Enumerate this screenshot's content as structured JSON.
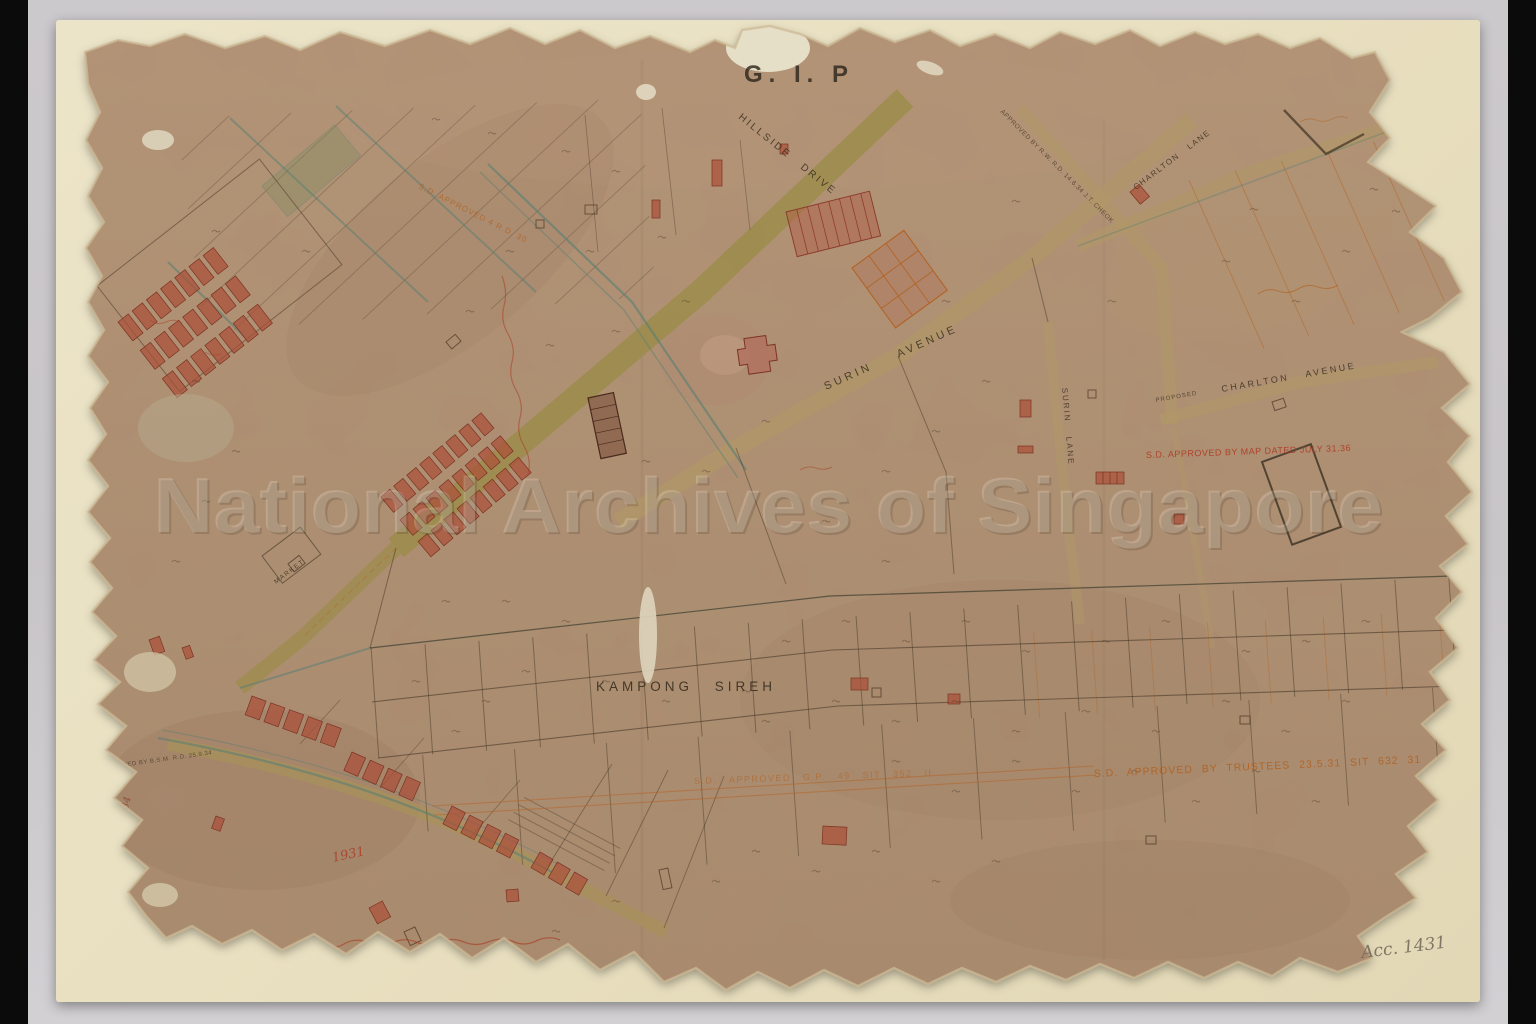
{
  "colors": {
    "orange_ink": "#b2601f",
    "red_ink": "#b03a24",
    "dark_ink": "#3c301f",
    "pencil": "#837a69",
    "map_paper": "#a8896c",
    "backing_paper": "#e9e0c1",
    "mat": "#cac7ca",
    "road_olive": "#9c8c4b",
    "road_tan": "#b19768",
    "drain_teal": "#567e73",
    "building_red": "#aa5039"
  },
  "archive": {
    "watermark": "National Archives of Singapore",
    "stamp": "G. I. P",
    "accession": "Acc. 1431",
    "pencil_number": "152",
    "margin_number": "A.L. No. 14.34",
    "year_note": "1931"
  },
  "streets": {
    "hillside": "HILLSIDE DRIVE",
    "surin_avenue": "SURIN AVENUE",
    "surin_lane": "SURIN LANE",
    "charlton_lane": "CHARLTON LANE",
    "charlton_avenue": "CHARLTON AVENUE",
    "charlton_note": "PROPOSED"
  },
  "places": {
    "kampong_sireh": "KAMPONG SIREH",
    "market": "MARKET"
  },
  "annotations": {
    "trustees": "S.D. APPROVED BY TRUSTEES 23.5.31 SIT 632 31",
    "map_approved": "S.D. APPROVED BY MAP DATED JULY 31.36",
    "sit_352": "S.D. APPROVED G.P. 49 SIT 352 II",
    "road_approved": "S.D. APPROVED 4 R.D. 30",
    "bsm": "APPROVED BY B.S.M. R.D. 25.9.34",
    "lane_approved": "APPROVED BY R.W. R.D. 14.6.34 J.T. CHEOK"
  }
}
